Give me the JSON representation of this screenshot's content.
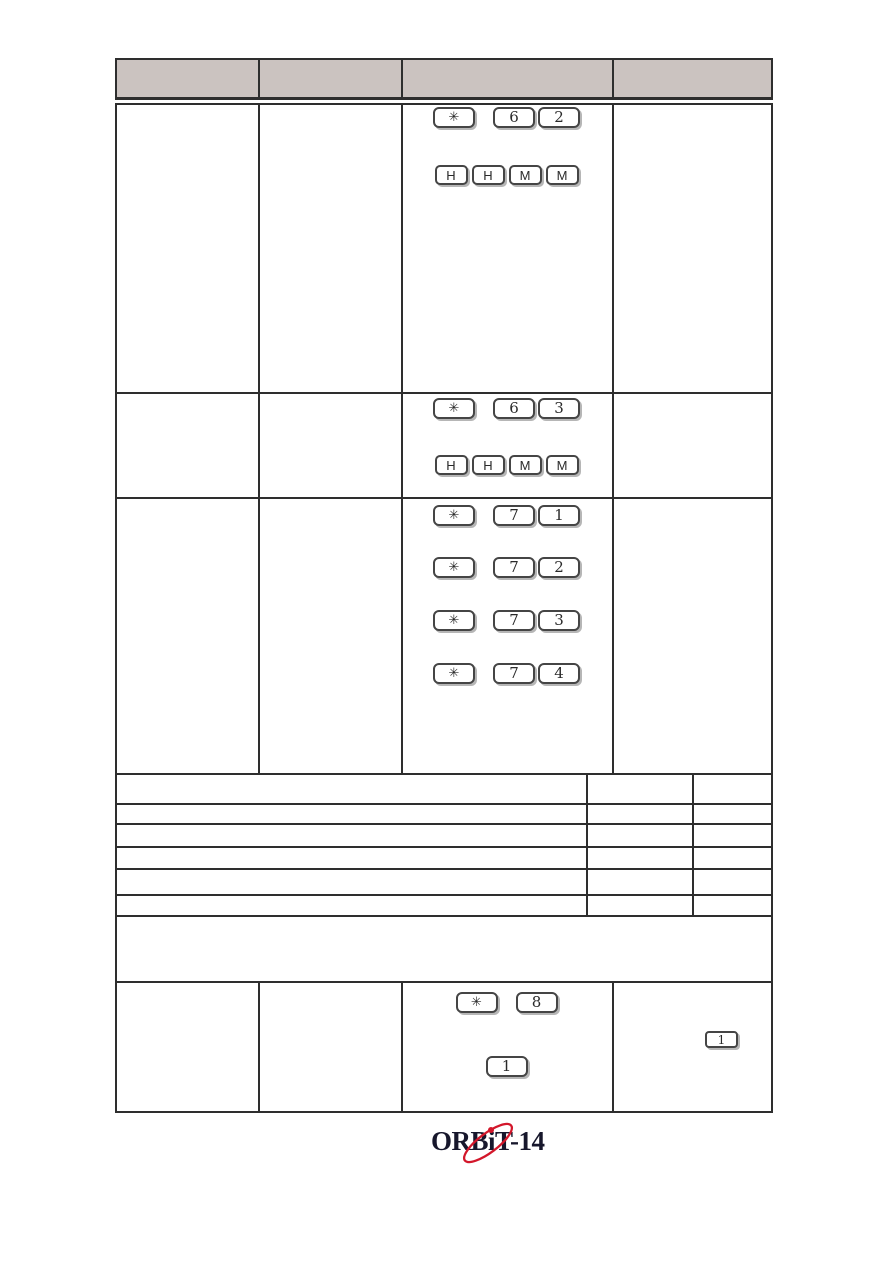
{
  "header": {
    "cells": [
      "",
      "",
      "",
      ""
    ]
  },
  "keys": {
    "row1_line1": [
      "✳",
      "6",
      "2"
    ],
    "row1_line2": [
      "H",
      "H",
      "M",
      "M"
    ],
    "row2_line1": [
      "✳",
      "6",
      "3"
    ],
    "row2_line2": [
      "H",
      "H",
      "M",
      "M"
    ],
    "row3_line1": [
      "✳",
      "7",
      "1"
    ],
    "row3_line2": [
      "✳",
      "7",
      "2"
    ],
    "row3_line3": [
      "✳",
      "7",
      "3"
    ],
    "row3_line4": [
      "✳",
      "7",
      "4"
    ],
    "row4_line1": [
      "✳",
      "8"
    ],
    "row4_line2": [
      "1"
    ],
    "row4_right_key": "1"
  },
  "logo": {
    "full_text": "ORBiT-14",
    "part1": "ORB",
    "part2": "i",
    "part3": "T-14"
  },
  "colors": {
    "header_fill": "#cbc3c0",
    "table_border": "#2e2e2e",
    "logo_text": "#17172c",
    "logo_accent": "#d3172b"
  }
}
